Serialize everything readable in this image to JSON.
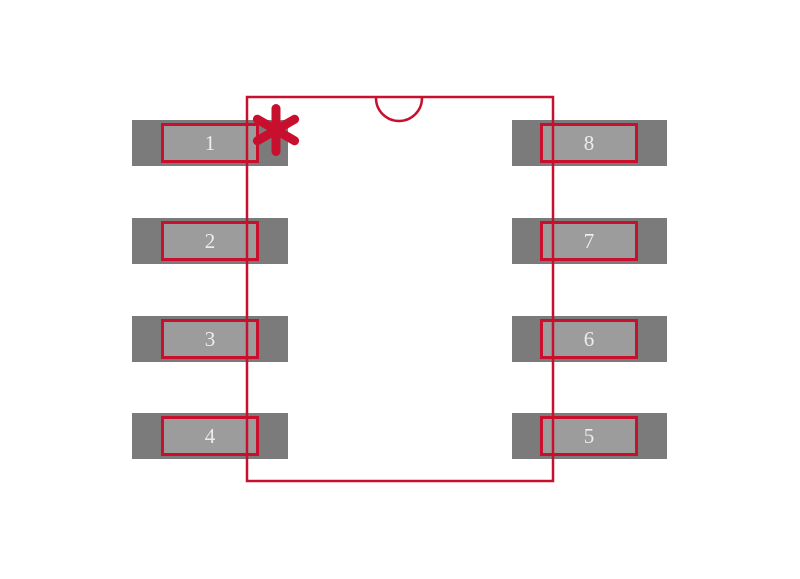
{
  "diagram": {
    "kind": "ic-footprint-drawing",
    "package_pin_count": 8,
    "orientation_features": {
      "notch": "semicircle-top-center",
      "pin1_marker": "asterisk"
    }
  },
  "colors": {
    "outline": "#c8102e",
    "pad_outer": "#7b7b7b",
    "pad_inner": "#9c9c9c",
    "pin_number": "#ededed",
    "background": "#ffffff"
  },
  "pins": {
    "left": [
      {
        "number": "1"
      },
      {
        "number": "2"
      },
      {
        "number": "3"
      },
      {
        "number": "4"
      }
    ],
    "right": [
      {
        "number": "8"
      },
      {
        "number": "7"
      },
      {
        "number": "6"
      },
      {
        "number": "5"
      }
    ]
  }
}
